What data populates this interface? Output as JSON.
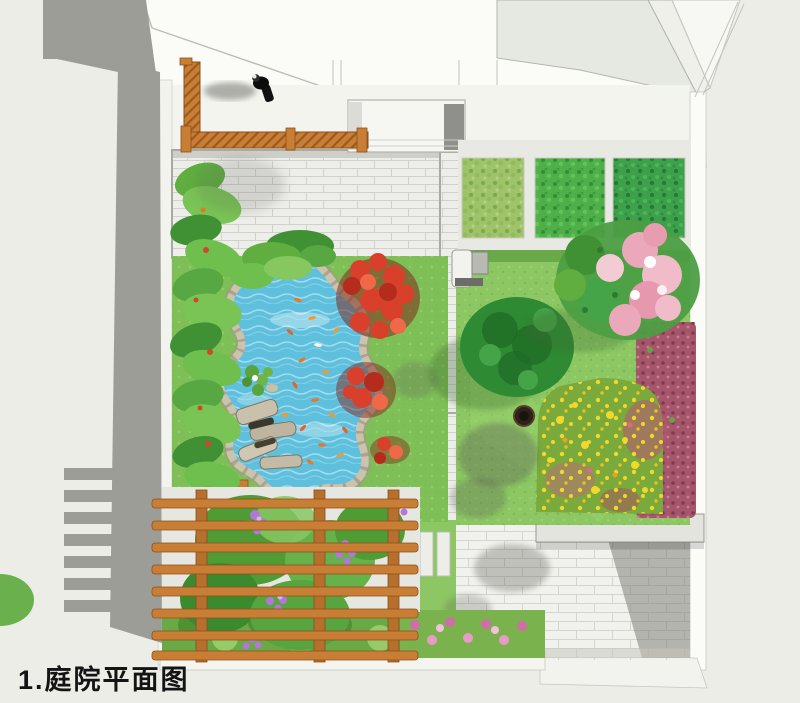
{
  "caption": {
    "label": "1.庭院平面图"
  },
  "palette": {
    "background": "#ecede6",
    "text_color": "#141414",
    "wall_gray": "#9d9d97",
    "building_white": "#fbfbf8",
    "paving": "#ededea",
    "paving_joint": "#d2d2cc",
    "patio_shadow": "#77776f",
    "lawn": "#8cc763",
    "lawn_shade": "#6aa94a",
    "veg_light": "#9fc36a",
    "veg_mid": "#4fb04a",
    "veg_dark": "#3da04b",
    "water": "#5fc0dd",
    "rock": "#cbc3ae",
    "wood": "#c87f35",
    "red_flower": "#d9402c",
    "purple_flower": "#b277d8",
    "yellow_flower": "#f2d829",
    "pink_canopy": "#eaa8ba",
    "magenta_bed": "#a5566b",
    "shrub_dark": "#2e8a33",
    "plant_green": "#5fae3f"
  }
}
